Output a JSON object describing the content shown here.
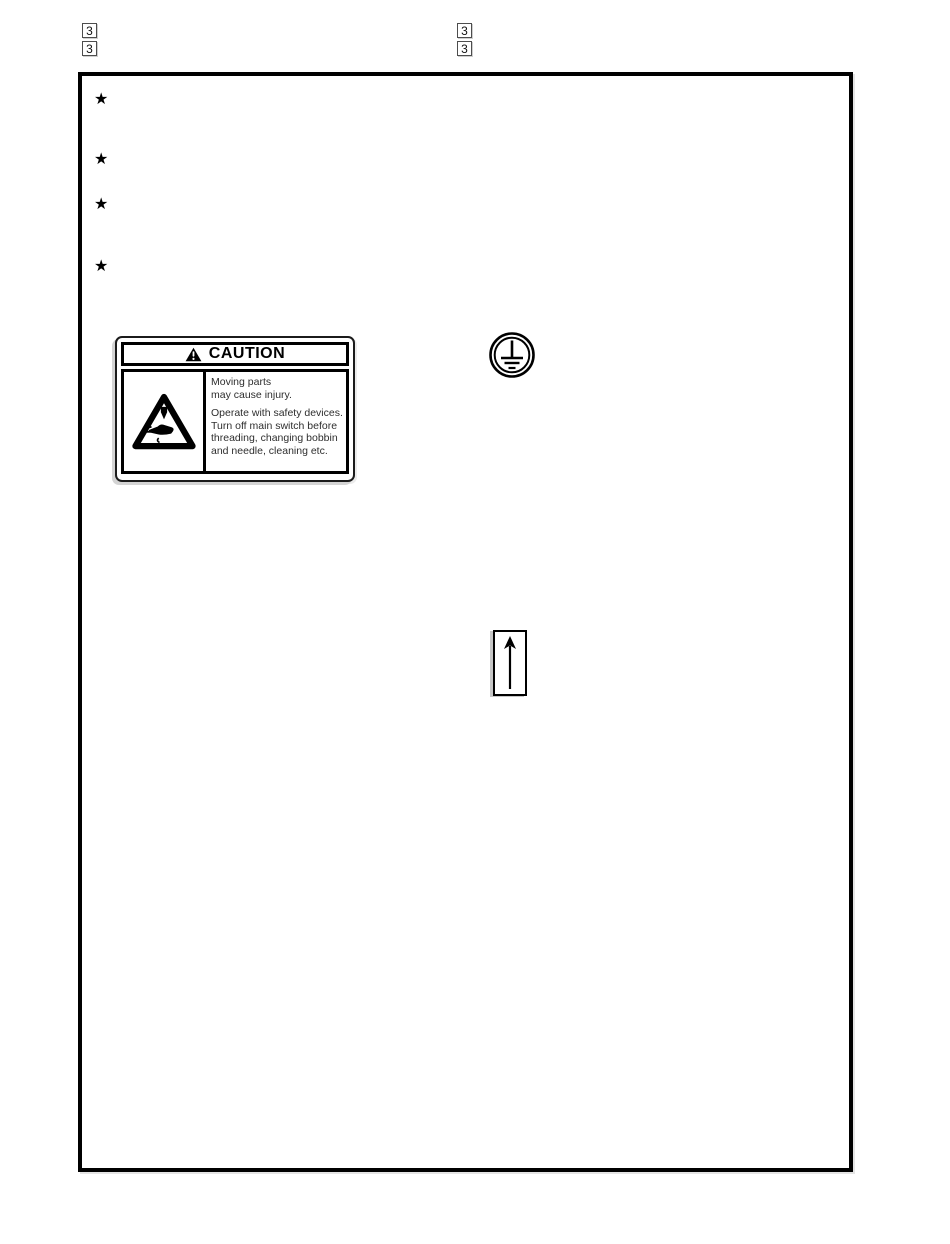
{
  "document": {
    "ref_markers": [
      "3",
      "3",
      "3",
      "3"
    ],
    "bullet_glyph": "★"
  },
  "caution_label": {
    "header": "CAUTION",
    "lines": [
      "Moving parts",
      "may cause injury.",
      "Operate with safety devices.",
      "Turn off main switch before",
      "threading, changing bobbin",
      "and needle, cleaning etc."
    ]
  },
  "icons": {
    "warning_triangle": "warning-triangle",
    "needle_hand": "needle-and-hand-pictogram",
    "ground": "protective-earth-ground-symbol",
    "up_arrow": "up-arrow"
  },
  "colors": {
    "ink": "#000000",
    "paper": "#ffffff",
    "scan_shadow": "#d4d4d4",
    "marker_border": "#4d4d4d"
  }
}
